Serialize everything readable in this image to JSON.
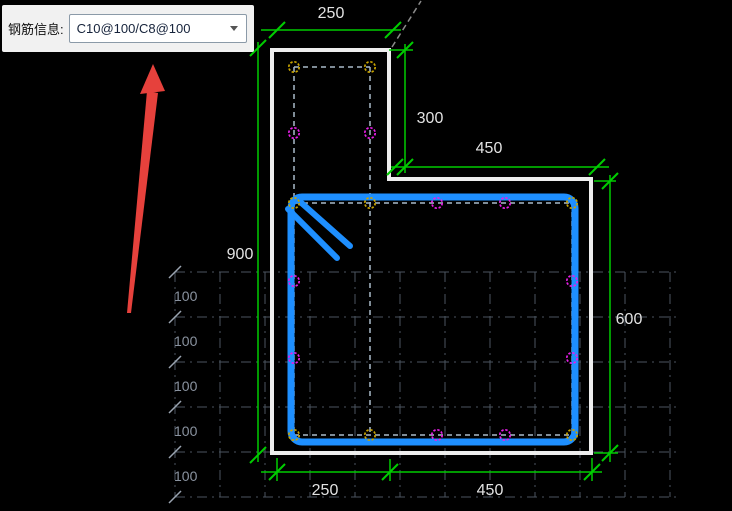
{
  "toolbar": {
    "label": "钢筋信息:",
    "rebar_combo": {
      "value": "C10@100/C8@100"
    }
  },
  "drawing": {
    "dimensions": {
      "top_width": "250",
      "flange_height": "300",
      "upper_right_width": "450",
      "total_height": "900",
      "right_height": "600",
      "bottom_flange_width": "250",
      "bottom_body_width": "450"
    },
    "left_spacing_labels": [
      "100",
      "100",
      "100",
      "100",
      "100"
    ],
    "colors": {
      "background": "#000000",
      "dimension_line": "#00cc00",
      "dimension_text": "#e2e2e2",
      "section_outline": "#eeeeee",
      "stirrup": "#1e8fff",
      "corner_bar_marker": "#c8a400",
      "side_bar_marker": "#e81ee8",
      "rebar_link_dash": "#a9bac9",
      "grid": "#4b5560",
      "grid_label": "#8a93a0",
      "annotation_arrow": "#e6413c"
    }
  }
}
